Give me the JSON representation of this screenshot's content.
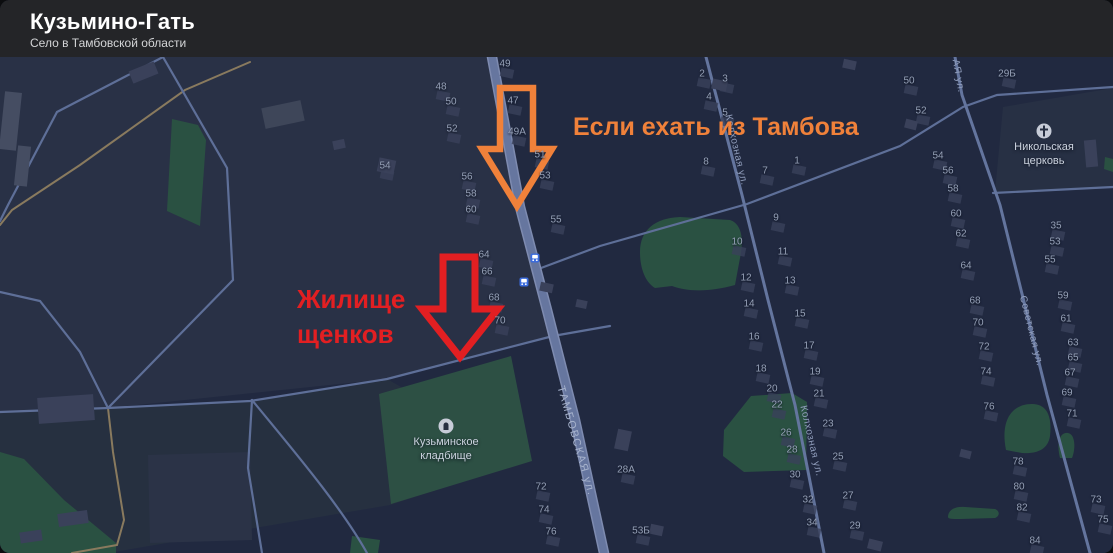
{
  "header": {
    "title": "Кузьмино-Гать",
    "subtitle": "Село в Тамбовской области"
  },
  "annotations": {
    "orange_text": "Если ехать из Тамбова",
    "red_text_line1": "Жилище",
    "red_text_line2": "щенков",
    "orange_color": "#f0813a",
    "red_color": "#e21f22"
  },
  "map": {
    "street_labels": [
      {
        "text": "ТАМБОВСКАЯ ул.",
        "x": 576,
        "y": 441,
        "rot": 74,
        "size": 11,
        "color": "#a7b3cd",
        "spacing": 1.5
      },
      {
        "text": "Колхозная ул.",
        "x": 736,
        "y": 150,
        "rot": 77,
        "size": 10,
        "color": "#8f9cba",
        "spacing": 0.6
      },
      {
        "text": "Колхозная ул.",
        "x": 811,
        "y": 441,
        "rot": 77,
        "size": 10,
        "color": "#8f9cba",
        "spacing": 0.6
      },
      {
        "text": "Советская ул.",
        "x": 1031,
        "y": 331,
        "rot": 76,
        "size": 10,
        "color": "#8f9cba",
        "spacing": 0.6
      },
      {
        "text": "АЯ ул.",
        "x": 958,
        "y": 76,
        "rot": 80,
        "size": 10,
        "color": "#8f9cba",
        "spacing": 0.6
      }
    ],
    "pois": [
      {
        "name": "cemetery",
        "icon": "grave-icon",
        "x": 446,
        "y": 426,
        "lines": [
          "Кузьминское",
          "кладбище"
        ]
      },
      {
        "name": "church",
        "icon": "church-icon",
        "x": 1044,
        "y": 131,
        "lines": [
          "Никольская",
          "церковь"
        ]
      }
    ],
    "bus_stops": [
      {
        "x": 535,
        "y": 258
      },
      {
        "x": 524,
        "y": 282
      }
    ],
    "colors": {
      "map_background": "#212940",
      "main_road": "#66769f",
      "minor_road": "#5e6f98",
      "dirt_path": "#897a5e",
      "green_area": "#2a5142",
      "cemetery_green": "#2d5044",
      "building": "#3a415a",
      "bus_blue": "#3a6bdd"
    },
    "house_numbers": [
      {
        "t": "49",
        "x": 505,
        "y": 64
      },
      {
        "t": "48",
        "x": 441,
        "y": 87
      },
      {
        "t": "50",
        "x": 451,
        "y": 102
      },
      {
        "t": "52",
        "x": 452,
        "y": 129
      },
      {
        "t": "54",
        "x": 385,
        "y": 166
      },
      {
        "t": "56",
        "x": 467,
        "y": 177
      },
      {
        "t": "58",
        "x": 471,
        "y": 194
      },
      {
        "t": "60",
        "x": 471,
        "y": 210
      },
      {
        "t": "64",
        "x": 484,
        "y": 255
      },
      {
        "t": "66",
        "x": 487,
        "y": 272
      },
      {
        "t": "68",
        "x": 494,
        "y": 298
      },
      {
        "t": "70",
        "x": 500,
        "y": 321
      },
      {
        "t": "72",
        "x": 541,
        "y": 487
      },
      {
        "t": "74",
        "x": 544,
        "y": 510
      },
      {
        "t": "76",
        "x": 551,
        "y": 532
      },
      {
        "t": "47",
        "x": 513,
        "y": 101
      },
      {
        "t": "49А",
        "x": 517,
        "y": 132
      },
      {
        "t": "51",
        "x": 540,
        "y": 155
      },
      {
        "t": "53",
        "x": 545,
        "y": 176
      },
      {
        "t": "55",
        "x": 556,
        "y": 220
      },
      {
        "t": "28А",
        "x": 626,
        "y": 470
      },
      {
        "t": "53Б",
        "x": 641,
        "y": 531
      },
      {
        "t": "2",
        "x": 702,
        "y": 74
      },
      {
        "t": "4",
        "x": 709,
        "y": 97
      },
      {
        "t": "8",
        "x": 706,
        "y": 162
      },
      {
        "t": "10",
        "x": 737,
        "y": 242
      },
      {
        "t": "12",
        "x": 746,
        "y": 278
      },
      {
        "t": "14",
        "x": 749,
        "y": 304
      },
      {
        "t": "16",
        "x": 754,
        "y": 337
      },
      {
        "t": "18",
        "x": 761,
        "y": 369
      },
      {
        "t": "20",
        "x": 772,
        "y": 389
      },
      {
        "t": "22",
        "x": 777,
        "y": 405
      },
      {
        "t": "26",
        "x": 786,
        "y": 433
      },
      {
        "t": "28",
        "x": 792,
        "y": 450
      },
      {
        "t": "30",
        "x": 795,
        "y": 475
      },
      {
        "t": "32",
        "x": 808,
        "y": 500
      },
      {
        "t": "34",
        "x": 812,
        "y": 523
      },
      {
        "t": "3",
        "x": 725,
        "y": 79
      },
      {
        "t": "5",
        "x": 725,
        "y": 113
      },
      {
        "t": "1",
        "x": 797,
        "y": 161
      },
      {
        "t": "7",
        "x": 765,
        "y": 171
      },
      {
        "t": "9",
        "x": 776,
        "y": 218
      },
      {
        "t": "11",
        "x": 783,
        "y": 252
      },
      {
        "t": "13",
        "x": 790,
        "y": 281
      },
      {
        "t": "15",
        "x": 800,
        "y": 314
      },
      {
        "t": "17",
        "x": 809,
        "y": 346
      },
      {
        "t": "19",
        "x": 815,
        "y": 372
      },
      {
        "t": "21",
        "x": 819,
        "y": 394
      },
      {
        "t": "23",
        "x": 828,
        "y": 424
      },
      {
        "t": "25",
        "x": 838,
        "y": 457
      },
      {
        "t": "27",
        "x": 848,
        "y": 496
      },
      {
        "t": "29",
        "x": 855,
        "y": 526
      },
      {
        "t": "50",
        "x": 909,
        "y": 81
      },
      {
        "t": "52",
        "x": 921,
        "y": 111
      },
      {
        "t": "54",
        "x": 938,
        "y": 156
      },
      {
        "t": "56",
        "x": 948,
        "y": 171
      },
      {
        "t": "58",
        "x": 953,
        "y": 189
      },
      {
        "t": "60",
        "x": 956,
        "y": 214
      },
      {
        "t": "62",
        "x": 961,
        "y": 234
      },
      {
        "t": "64",
        "x": 966,
        "y": 266
      },
      {
        "t": "68",
        "x": 975,
        "y": 301
      },
      {
        "t": "70",
        "x": 978,
        "y": 323
      },
      {
        "t": "72",
        "x": 984,
        "y": 347
      },
      {
        "t": "74",
        "x": 986,
        "y": 372
      },
      {
        "t": "76",
        "x": 989,
        "y": 407
      },
      {
        "t": "78",
        "x": 1018,
        "y": 462
      },
      {
        "t": "80",
        "x": 1019,
        "y": 487
      },
      {
        "t": "82",
        "x": 1022,
        "y": 508
      },
      {
        "t": "84",
        "x": 1035,
        "y": 541
      },
      {
        "t": "29Б",
        "x": 1007,
        "y": 74
      },
      {
        "t": "35",
        "x": 1056,
        "y": 226
      },
      {
        "t": "53",
        "x": 1055,
        "y": 242
      },
      {
        "t": "55",
        "x": 1050,
        "y": 260
      },
      {
        "t": "59",
        "x": 1063,
        "y": 296
      },
      {
        "t": "61",
        "x": 1066,
        "y": 319
      },
      {
        "t": "63",
        "x": 1073,
        "y": 343
      },
      {
        "t": "65",
        "x": 1073,
        "y": 358
      },
      {
        "t": "67",
        "x": 1070,
        "y": 373
      },
      {
        "t": "69",
        "x": 1067,
        "y": 393
      },
      {
        "t": "71",
        "x": 1072,
        "y": 414
      },
      {
        "t": "73",
        "x": 1096,
        "y": 500
      },
      {
        "t": "75",
        "x": 1103,
        "y": 520
      }
    ]
  }
}
